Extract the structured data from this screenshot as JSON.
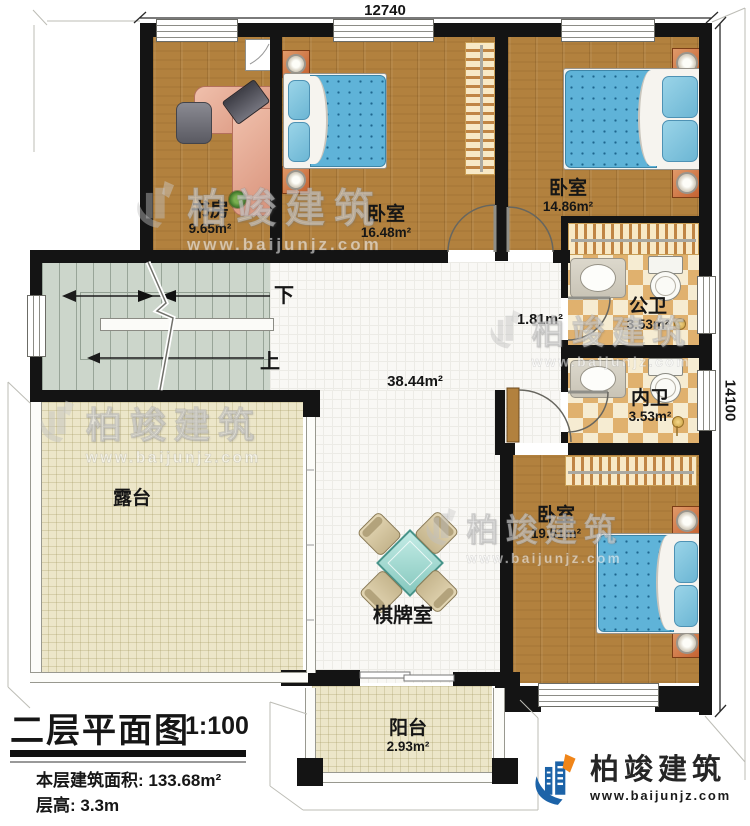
{
  "plan": {
    "dim_top": "12740",
    "dim_right": "14100",
    "stair_down": "下",
    "stair_up": "上",
    "hall_area": "38.44m²",
    "corridor_area": "1.81m²",
    "rooms": {
      "study": {
        "name": "书房",
        "area": "9.65m²"
      },
      "bedroom_top": {
        "name": "卧室",
        "area": "16.48m²"
      },
      "bedroom_right": {
        "name": "卧室",
        "area": "14.86m²"
      },
      "bedroom_bottom": {
        "name": "卧室",
        "area": "19.51m²"
      },
      "public_bath": {
        "name": "公卫",
        "area": "3.53m²"
      },
      "private_bath": {
        "name": "内卫",
        "area": "3.53m²"
      },
      "terrace": {
        "name": "露台"
      },
      "game_room": {
        "name": "棋牌室"
      },
      "balcony": {
        "name": "阳台",
        "area": "2.93m²"
      }
    }
  },
  "title_block": {
    "title": "二层平面图",
    "scale": "1:100",
    "area_line": "本层建筑面积: 133.68m²",
    "height_line": "层高: 3.3m"
  },
  "brand": {
    "name": "柏竣建筑",
    "url": "www.baijunjz.com"
  },
  "watermark": {
    "name": "柏竣建筑",
    "url": "www.baijunjz.com"
  },
  "colors": {
    "wall": "#141414",
    "wood": "#b2813e",
    "accent_blue": "#1c63a8",
    "accent_orange": "#f08519",
    "bed": "#5fb3d8",
    "stair": "#ccd6cb"
  }
}
